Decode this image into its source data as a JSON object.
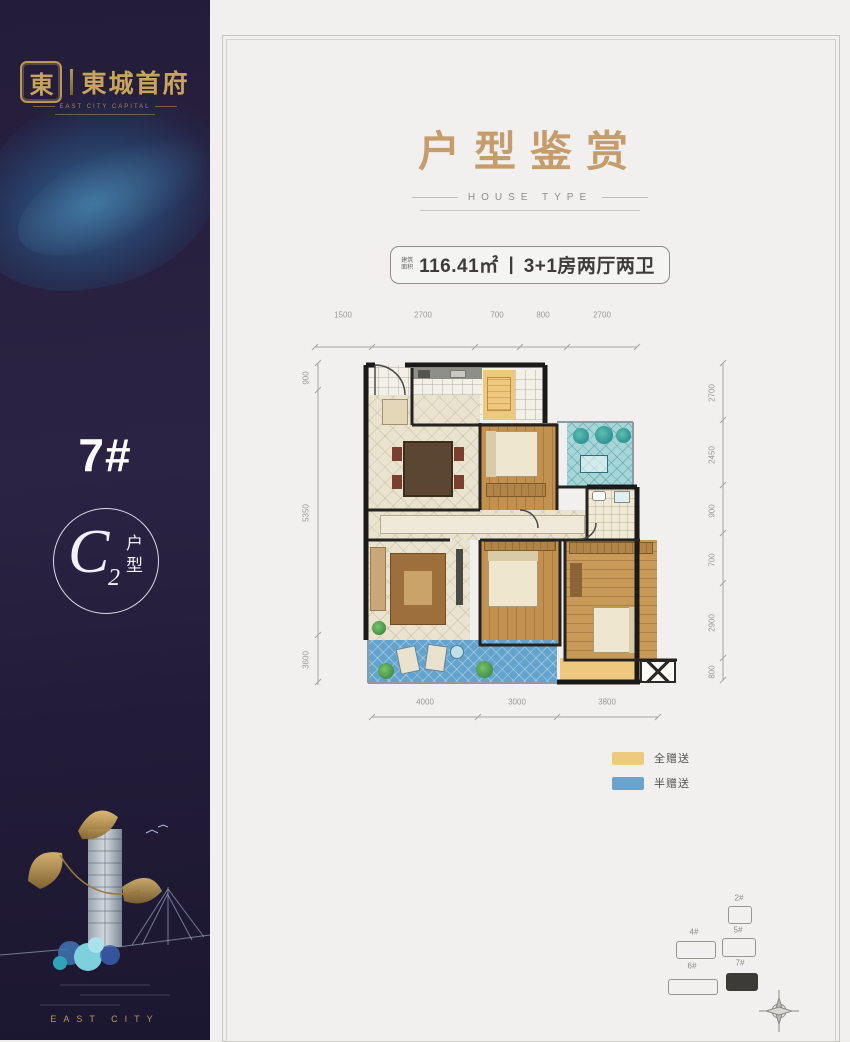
{
  "sidebar": {
    "logo": {
      "seal": "東",
      "name": "東城首府",
      "subtitle": "EAST CITY CAPITAL"
    },
    "building_no": "7#",
    "unit": {
      "letter": "C",
      "number": "2",
      "suffix_top": "户",
      "suffix_bottom": "型"
    },
    "footer": "EAST CITY"
  },
  "header": {
    "title": "户型鉴赏",
    "subtitle": "HOUSE TYPE"
  },
  "badge": {
    "prefix_line1": "建筑",
    "prefix_line2": "面积",
    "area": "116.41㎡",
    "separator": "|",
    "layout": "3+1房两厅两卫"
  },
  "floorplan": {
    "dims": {
      "top": [
        "1500",
        "2700",
        "700",
        "800",
        "2700"
      ],
      "bottom": [
        "4000",
        "3000",
        "3800"
      ],
      "left": [
        "900",
        "5350",
        "3600"
      ],
      "right": [
        "2700",
        "2450",
        "900",
        "700",
        "2900",
        "800"
      ]
    }
  },
  "legend": {
    "items": [
      {
        "label": "全赠送",
        "color": "#EDCB7E"
      },
      {
        "label": "半赠送",
        "color": "#6CA3CD"
      }
    ]
  },
  "siteplan": {
    "buildings": [
      {
        "label": "2#",
        "highlighted": false
      },
      {
        "label": "4#",
        "highlighted": false
      },
      {
        "label": "5#",
        "highlighted": false
      },
      {
        "label": "6#",
        "highlighted": false
      },
      {
        "label": "7#",
        "highlighted": true
      }
    ]
  },
  "colors": {
    "accent_gold": "#C59D6D",
    "sidebar_bg": "#2A2240",
    "logo_gold": "#C9A45E",
    "wall": "#1A1A1A"
  }
}
